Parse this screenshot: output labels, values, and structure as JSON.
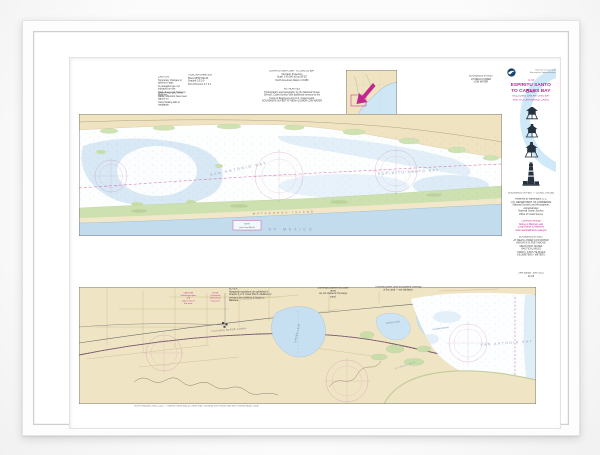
{
  "right_panel": {
    "header": [
      "National Oceanic and",
      "Atmospheric Administration"
    ],
    "chart_number": "11315",
    "title1": "ESPIRITU SANTO BAY",
    "title2": "TO CARLOS BAY",
    "subtitle1": "INCLUDING SAN ANTONIO BAY",
    "subtitle2": "AND VICTORIA BARGE CANAL",
    "scale_line": "SOUNDINGS IN FEET — SCALE 1:40,000",
    "info_block": [
      "Published at Washington, D.C.",
      "U.S. DEPARTMENT OF COMMERCE",
      "National Oceanic and Atmospheric",
      "Administration",
      "National Ocean Service",
      "Office of Coast Survey"
    ],
    "magenta_block": [
      "Corrected through",
      "Notice to Mariners and",
      "Local Notice to Mariners",
      "www.nauticalcharts.noaa.gov"
    ],
    "index_block": [
      "SOUNDINGS IN FEET",
      "AT MEAN LOWER LOW WATER",
      "HEIGHTS IN FEET ABOVE",
      "MEAN HIGH WATER",
      "NAUTICAL MILES",
      "YARDS  •  STATUTE MILES",
      "KILOMETERS  •  METERS"
    ],
    "footer": [
      "24th Edition, June 2015",
      "11315"
    ]
  },
  "notes_top": {
    "caution": [
      "CAUTION",
      "Temporary changes or defects in aids",
      "to navigation are not indicated on this",
      "chart. See Local Notice to Mariners."
    ],
    "radar": [
      "RADAR REFLECTORS",
      "Radar reflectors have been placed on",
      "many floating aids to navigation."
    ],
    "tidal": [
      "TIDAL INFORMATION",
      "Place            MHW    MLLW",
      "Seadrift          0.5      0.0",
      "Port O'Connor   0.7      0.1"
    ],
    "projection": [
      "ESPIRITU SANTO BAY TO CARLOS BAY",
      "Mercator Projection",
      "Scale 1:40,000 at Lat 28°20'",
      "North American Datum of 1983"
    ],
    "authorities": [
      "AUTHORITIES",
      "Hydrography and topography by the National Ocean",
      "Service, Coast Survey, with additional surveys by the",
      "Corps of Engineers and U.S. Coast Guard.",
      "SOUNDINGS IN FEET AT MEAN LOWER LOW WATER"
    ],
    "soundings": [
      "SOUNDINGS IN FEET",
      "AT MEAN LOWER",
      "LOW WATER"
    ]
  },
  "notes_lower": {
    "caution1": [
      "CAUTION",
      "Submerged piles and",
      "stakes exist in this area."
    ],
    "caution2": [
      "NOTE",
      "Uncharted obstructions",
      "may exist."
    ],
    "note_a": [
      "NOTE A",
      "Navigation regulations are published in",
      "Chapter 2, U.S. Coast Pilot 5. Additions or",
      "revisions are published in Notice to Mariners."
    ],
    "pipeline": [
      "Submerged pipeline and cable areas",
      "are not charted in the barge canal."
    ],
    "crossings": [
      "Overhead power cable and pipeline crossings",
      "of the canal — see tabulation."
    ]
  },
  "upper_chart": {
    "bay_left": "SAN ANTONIO BAY",
    "bay_right": "ESPIRITU SANTO BAY",
    "island": "MATAGORDA ISLAND",
    "gulf": "GULF OF MEXICO",
    "note_box": [
      "NOTE",
      "(see Coast Pilot 5)"
    ]
  },
  "lower_chart": {
    "bay": "SAN ANTONIO BAY",
    "hynes": "HYNES BAY",
    "green_lake": "GREEN LAKE",
    "mission": "MISSION LAKE",
    "guadalupe": "GUADALUPE BAY",
    "canal": "VICTORIA BARGE CANAL"
  },
  "caption": "NOAA Nautical Chart 11315 — Espiritu Santo Bay to Carlos Bay, including San Antonio Bay and Victoria Barge Canal",
  "colors": {
    "magenta": "#c2268f",
    "water": "#c2dcee",
    "land": "#efe4c4",
    "marsh": "#cfe2b2",
    "swoosh": "#cfe9f8"
  }
}
